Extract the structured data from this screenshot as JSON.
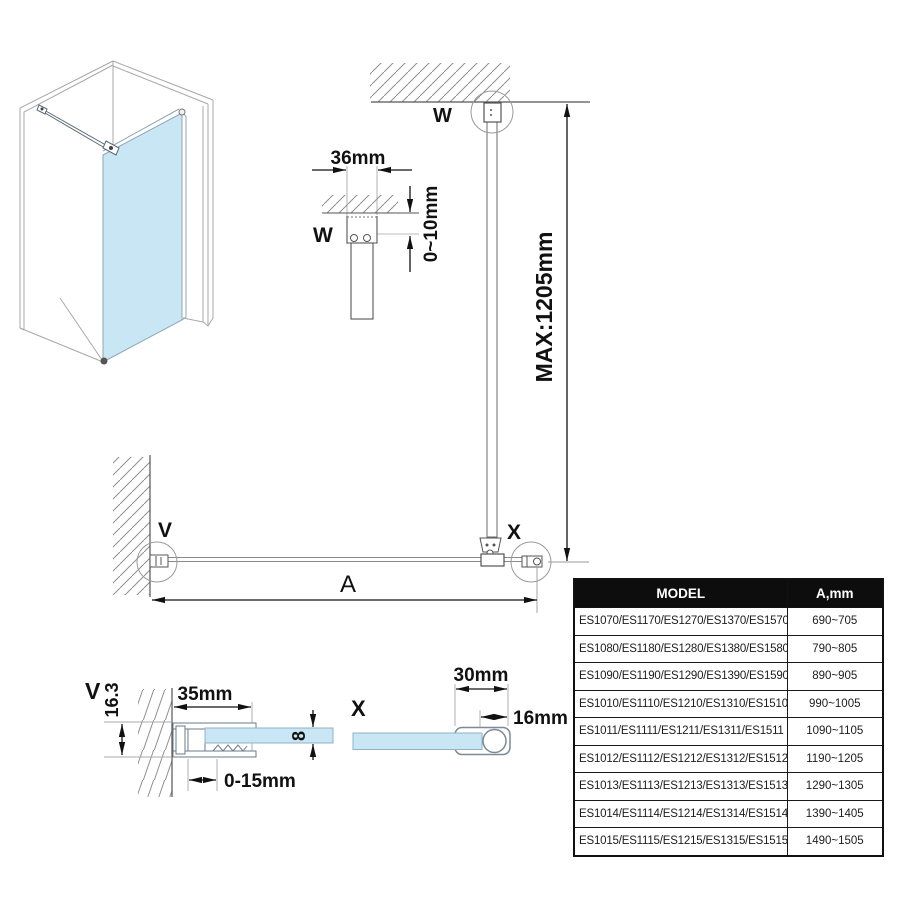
{
  "drawing": {
    "callouts": {
      "w_main": "W",
      "w_detail": "W",
      "v_main": "V",
      "v_detail": "V",
      "x_main": "X",
      "x_detail": "X"
    },
    "dimensions": {
      "bracket_width": "36mm",
      "ceiling_gap": "0~10mm",
      "max_height": "MAX:1205mm",
      "panel_width": "A",
      "profile_depth": "16.3",
      "profile_width": "35mm",
      "wall_adjustment": "0-15mm",
      "glass_thickness": "8",
      "clamp_width": "30mm",
      "clamp_offset": "16mm"
    },
    "colors": {
      "glass": "#c9e6f5",
      "outline": "#5c6a73",
      "dimension": "#111111",
      "hatch": "#8f8f8f"
    }
  },
  "table": {
    "headers": [
      "MODEL",
      "A,mm"
    ],
    "rows": [
      {
        "model": "ES1070/ES1170/ES1270/ES1370/ES1570",
        "a_mm": "690~705"
      },
      {
        "model": "ES1080/ES1180/ES1280/ES1380/ES1580",
        "a_mm": "790~805"
      },
      {
        "model": "ES1090/ES1190/ES1290/ES1390/ES1590",
        "a_mm": "890~905"
      },
      {
        "model": "ES1010/ES1110/ES1210/ES1310/ES1510",
        "a_mm": "990~1005"
      },
      {
        "model": "ES1011/ES1111/ES1211/ES1311/ES1511",
        "a_mm": "1090~1105"
      },
      {
        "model": "ES1012/ES1112/ES1212/ES1312/ES1512",
        "a_mm": "1190~1205"
      },
      {
        "model": "ES1013/ES1113/ES1213/ES1313/ES1513",
        "a_mm": "1290~1305"
      },
      {
        "model": "ES1014/ES1114/ES1214/ES1314/ES1514",
        "a_mm": "1390~1405"
      },
      {
        "model": "ES1015/ES1115/ES1215/ES1315/ES1515",
        "a_mm": "1490~1505"
      }
    ]
  }
}
